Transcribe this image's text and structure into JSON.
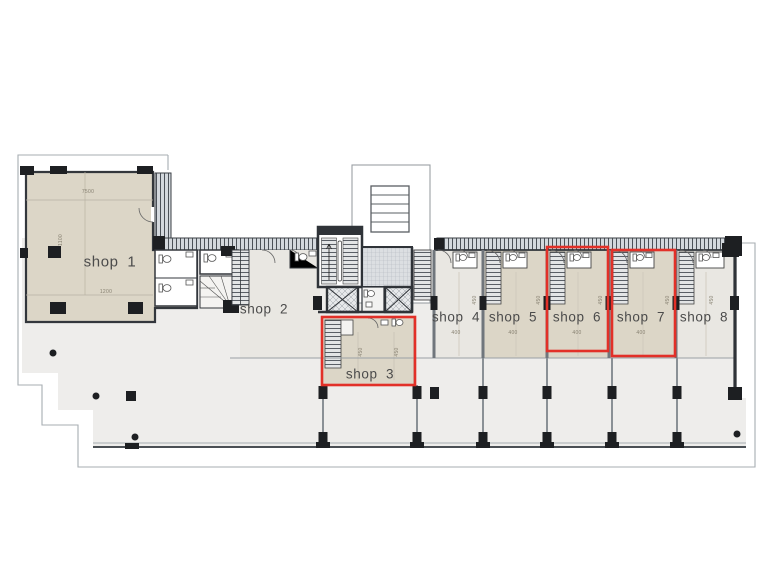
{
  "plan": {
    "shops": [
      {
        "id": 1,
        "label": "shop 1",
        "highlighted": false
      },
      {
        "id": 2,
        "label": "shop 2",
        "highlighted": false
      },
      {
        "id": 3,
        "label": "shop 3",
        "highlighted": true
      },
      {
        "id": 4,
        "label": "shop 4",
        "highlighted": false
      },
      {
        "id": 5,
        "label": "shop 5",
        "highlighted": false
      },
      {
        "id": 6,
        "label": "shop 6",
        "highlighted": true
      },
      {
        "id": 7,
        "label": "shop 7",
        "highlighted": true
      },
      {
        "id": 8,
        "label": "shop 8",
        "highlighted": false
      }
    ],
    "dims": {
      "shop1_top": "7500",
      "shop1_left": "1100",
      "shop1_front": "1200",
      "shop_width": "400",
      "shop_depth": "450"
    },
    "colors": {
      "highlight_red": "#e23028",
      "shop_fill_beige": "#dcd6c7",
      "shop_fill_light": "#e9e7e2",
      "terrace_fill": "#eeedeb",
      "wall_dark": "#2f3338",
      "band_fill": "#d3d8dd"
    }
  }
}
